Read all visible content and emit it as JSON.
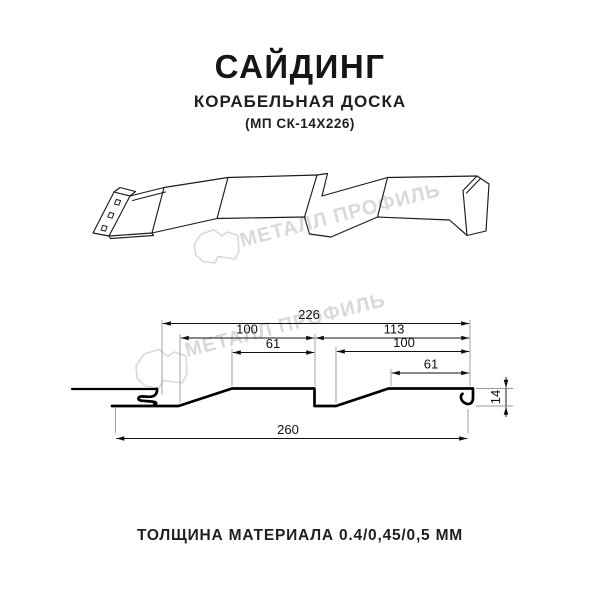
{
  "header": {
    "title": "САЙДИНГ",
    "subtitle": "КОРАБЕЛЬНАЯ ДОСКА",
    "model": "(МП СК-14Х226)"
  },
  "watermark": {
    "text": "МЕТАЛЛ ПРОФИЛЬ",
    "color": "#d9d9d9"
  },
  "drawing": {
    "line_color": "#1b1b1b",
    "profile_color": "#000000"
  },
  "dimensions": {
    "overall_top": "226",
    "left_panel": "100",
    "left_flat": "61",
    "right_section": "113",
    "right_panel": "100",
    "right_flat": "61",
    "total_width": "260",
    "profile_height": "14"
  },
  "footer": {
    "thickness": "ТОЛЩИНА МАТЕРИАЛА 0.4/0,45/0,5 ММ"
  }
}
